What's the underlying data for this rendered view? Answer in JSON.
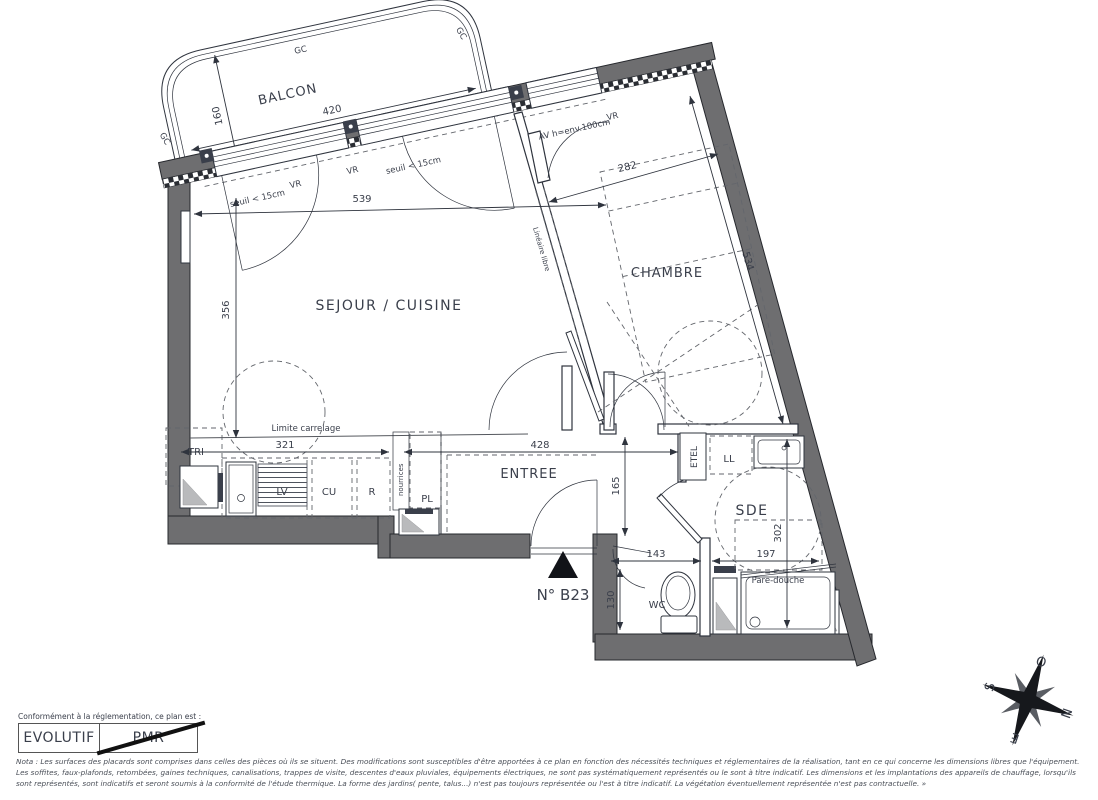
{
  "unit": {
    "number_label": "N° B23"
  },
  "rooms": {
    "balcon": "BALCON",
    "sejour": "SEJOUR / CUISINE",
    "chambre": "CHAMBRE",
    "entree": "ENTREE",
    "wc": "WC",
    "sde": "SDE"
  },
  "fixtures": {
    "tri": "TRI",
    "lv": "LV",
    "cu": "CU",
    "r": "R",
    "pl": "PL",
    "ll": "LL",
    "etel": "ETEL",
    "nourrices": "nourrices",
    "pare_douche": "Pare-douche",
    "limite_carrelage": "Limite carrelage",
    "lineaire_libre": "Linéaire libre"
  },
  "annotations": {
    "vr": "VR",
    "gc": "GC",
    "seuil": "seuil < 15cm",
    "av_window": "AV h=env.100cm"
  },
  "dimensions": {
    "balcon_l": "420",
    "balcon_d": "160",
    "sejour_l": "539",
    "sejour_w": "356",
    "cuisine_l": "321",
    "chambre_l": "282",
    "chambre_w": "534",
    "entree_l": "428",
    "entree_w": "165",
    "wc_l": "143",
    "wc_w": "130",
    "sde_l": "197",
    "sde_w": "302"
  },
  "compliance": {
    "intro": "Conformément à la réglementation, ce plan est :",
    "evolutif": "EVOLUTIF",
    "pmr": "PMR"
  },
  "compass": {
    "n": "N",
    "s": "S",
    "e": "E",
    "o": "O"
  },
  "nota": "Nota : Les surfaces des placards sont comprises dans celles des pièces où ils se situent. Des modifications sont susceptibles d'être apportées à ce plan en fonction des nécessités techniques et réglementaires de la réalisation, tant en ce qui concerne les dimensions libres que l'équipement.  Les soffites, faux-plafonds, retombées, gaines techniques, canalisations, trappes de visite, descentes d'eaux pluviales, équipements électriques, ne sont pas systématiquement représentés ou le sont à titre indicatif. Les dimensions et les implantations des appareils de chauffage, lorsqu'ils sont représentés, sont indicatifs et seront soumis à la conformité de l'étude thermique. La forme des jardins( pente, talus...) n'est pas toujours représentée ou l'est à titre indicatif. La végétation éventuellement représentée n'est pas contractuelle. »",
  "colors": {
    "wall": "#6e6e70",
    "line": "#2f343e",
    "text": "#3a3f4b"
  }
}
